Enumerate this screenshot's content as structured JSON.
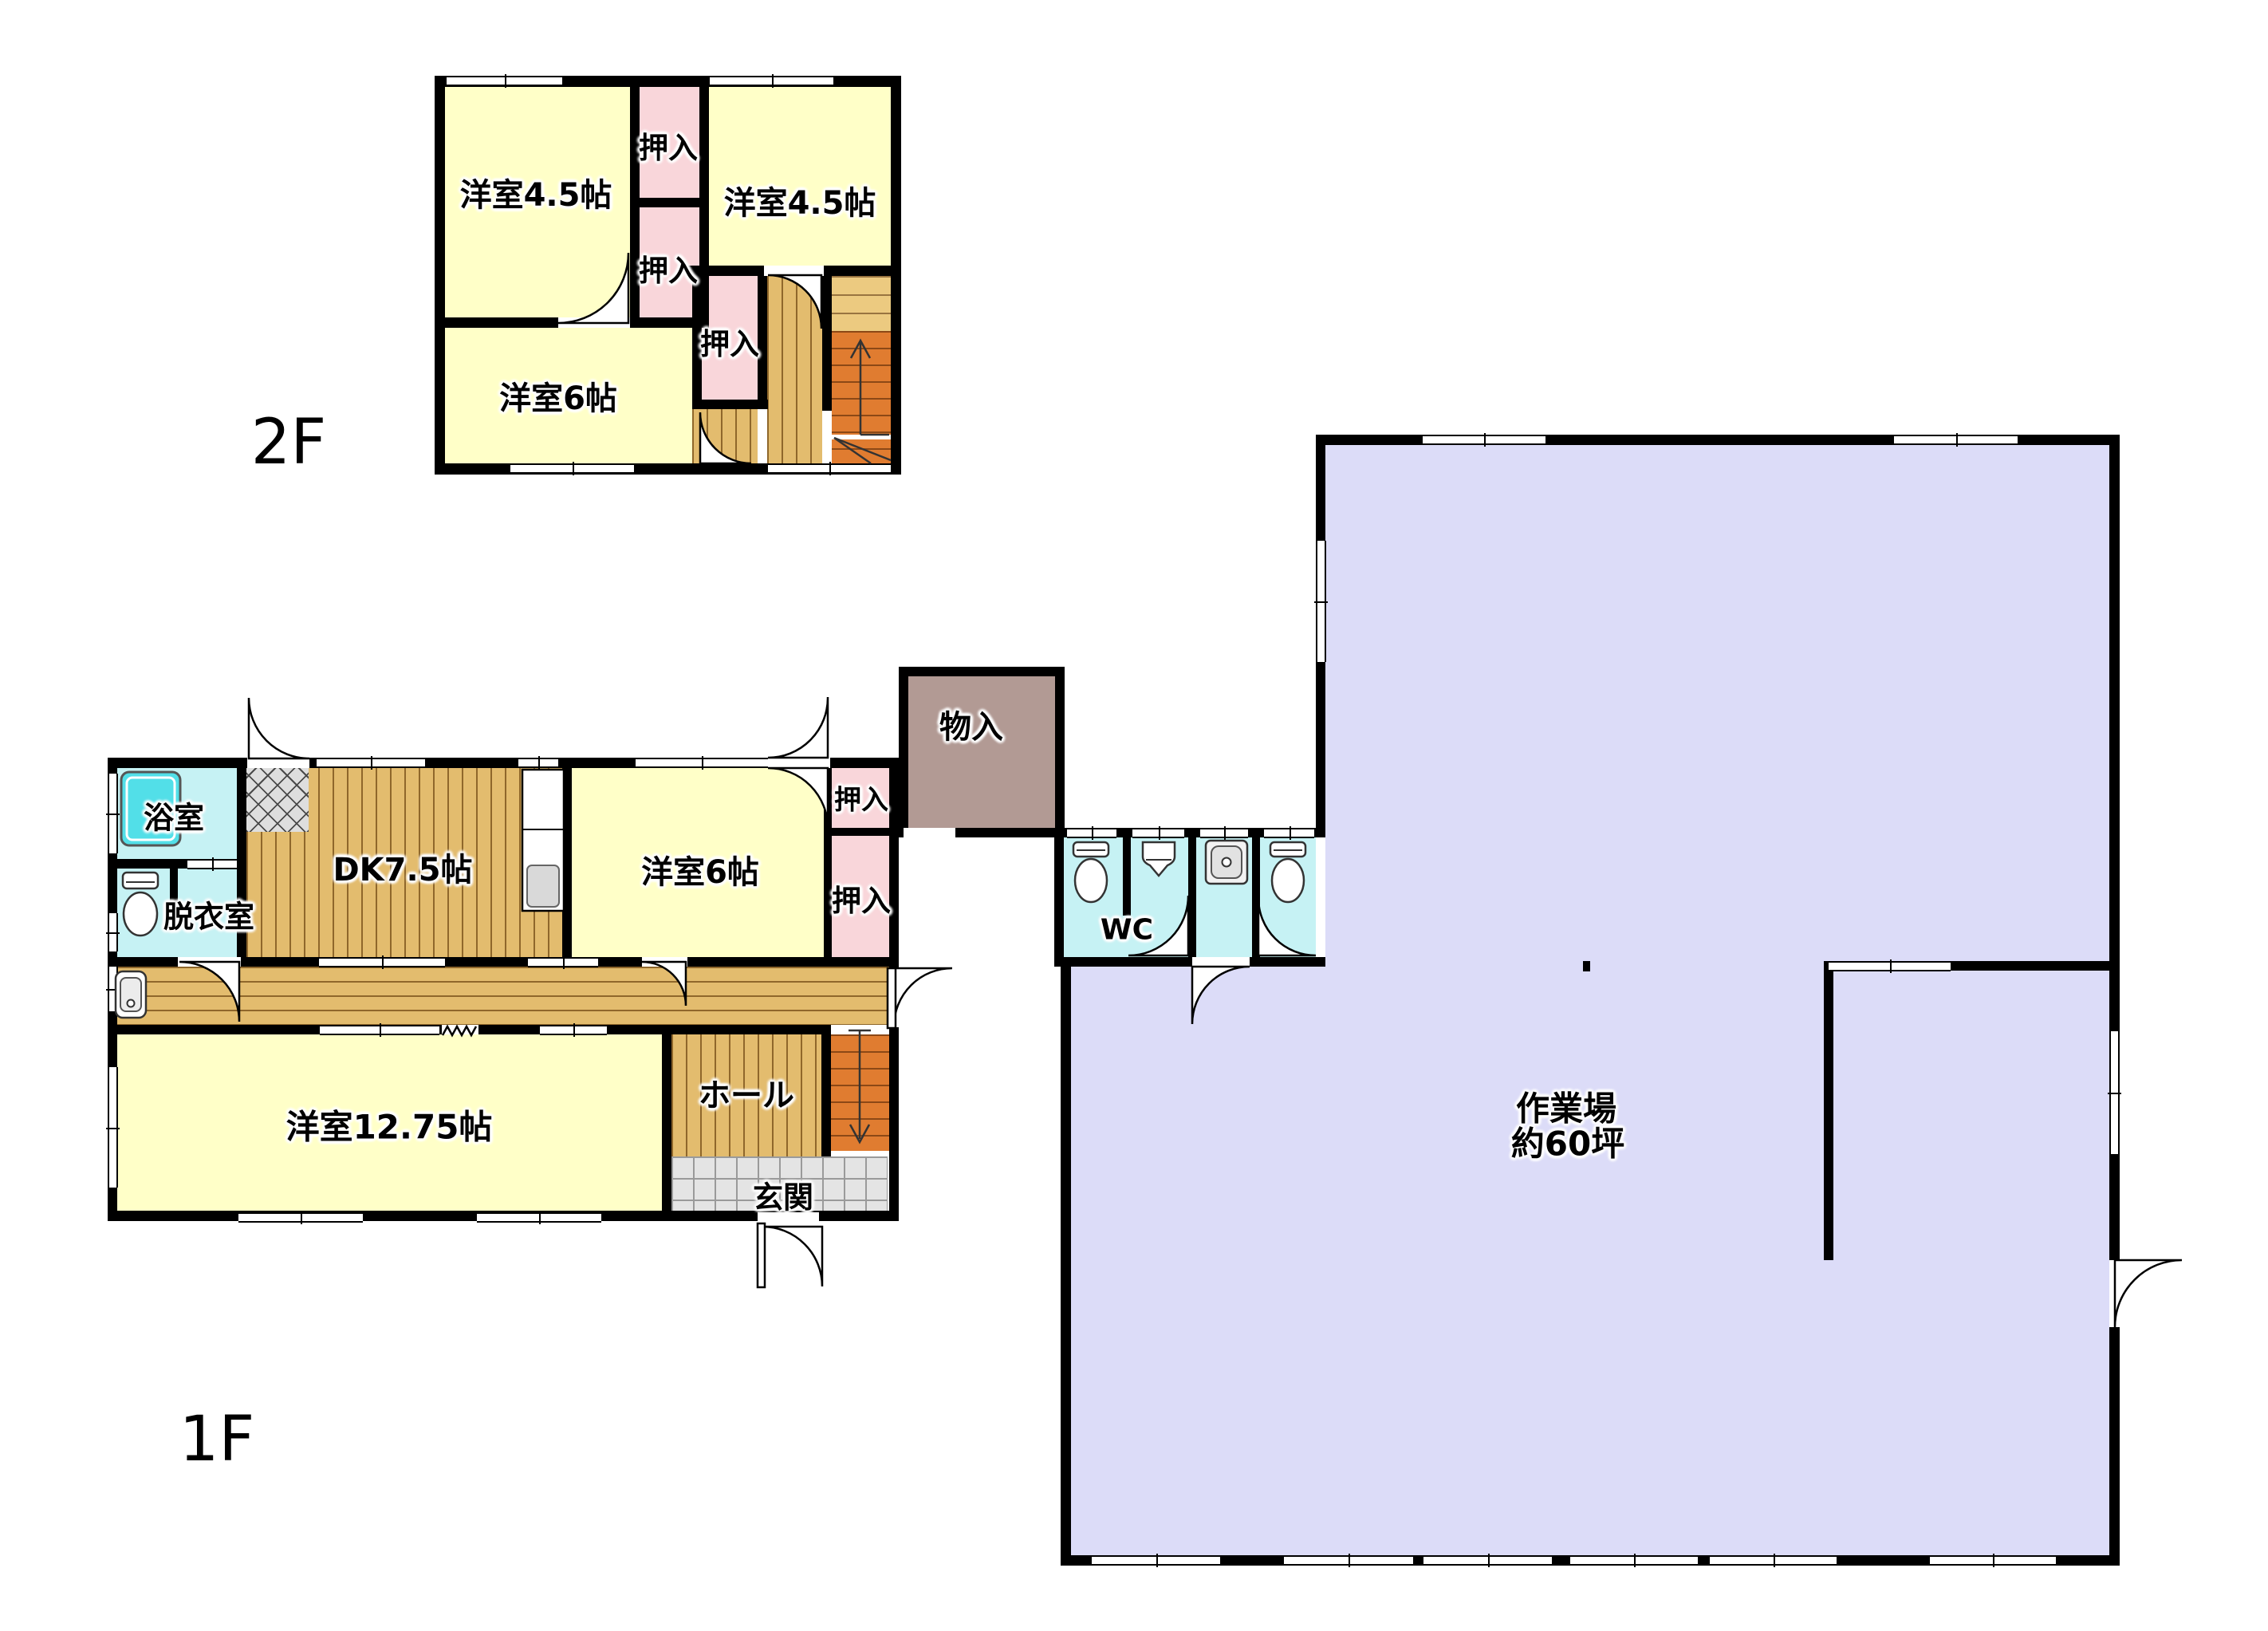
{
  "floors": {
    "f2": {
      "label": "2F",
      "rooms": {
        "west_45": "洋室4.5帖",
        "closet_a": "押入",
        "east_45": "洋室4.5帖",
        "closet_b": "押入",
        "south_6": "洋室6帖",
        "closet_c": "押入"
      }
    },
    "f1": {
      "label": "1F",
      "rooms": {
        "bath": "浴室",
        "dressing": "脱衣室",
        "dk": "DK7.5帖",
        "east_6": "洋室6帖",
        "closet_upper": "押入",
        "closet_lower": "押入",
        "storage": "物入",
        "wc": "WC",
        "hall": "ホール",
        "entrance": "玄関",
        "south_1275": "洋室12.75帖",
        "workshop_name": "作業場",
        "workshop_size": "約60坪"
      }
    }
  },
  "colors": {
    "room_yellow": "#ffffc8",
    "closet_pink": "#f9d6da",
    "sanitary_cyan": "#c6f2f4",
    "bathtub_teal": "#52dfe8",
    "wood": "#e3bc6e",
    "stair_orange": "#e07c30",
    "stair_light": "#ecca80",
    "tile_grey": "#e4e4e4",
    "storage_mauve": "#b29a94",
    "workshop_lavender": "#dcdcf8",
    "wall": "#000000"
  }
}
